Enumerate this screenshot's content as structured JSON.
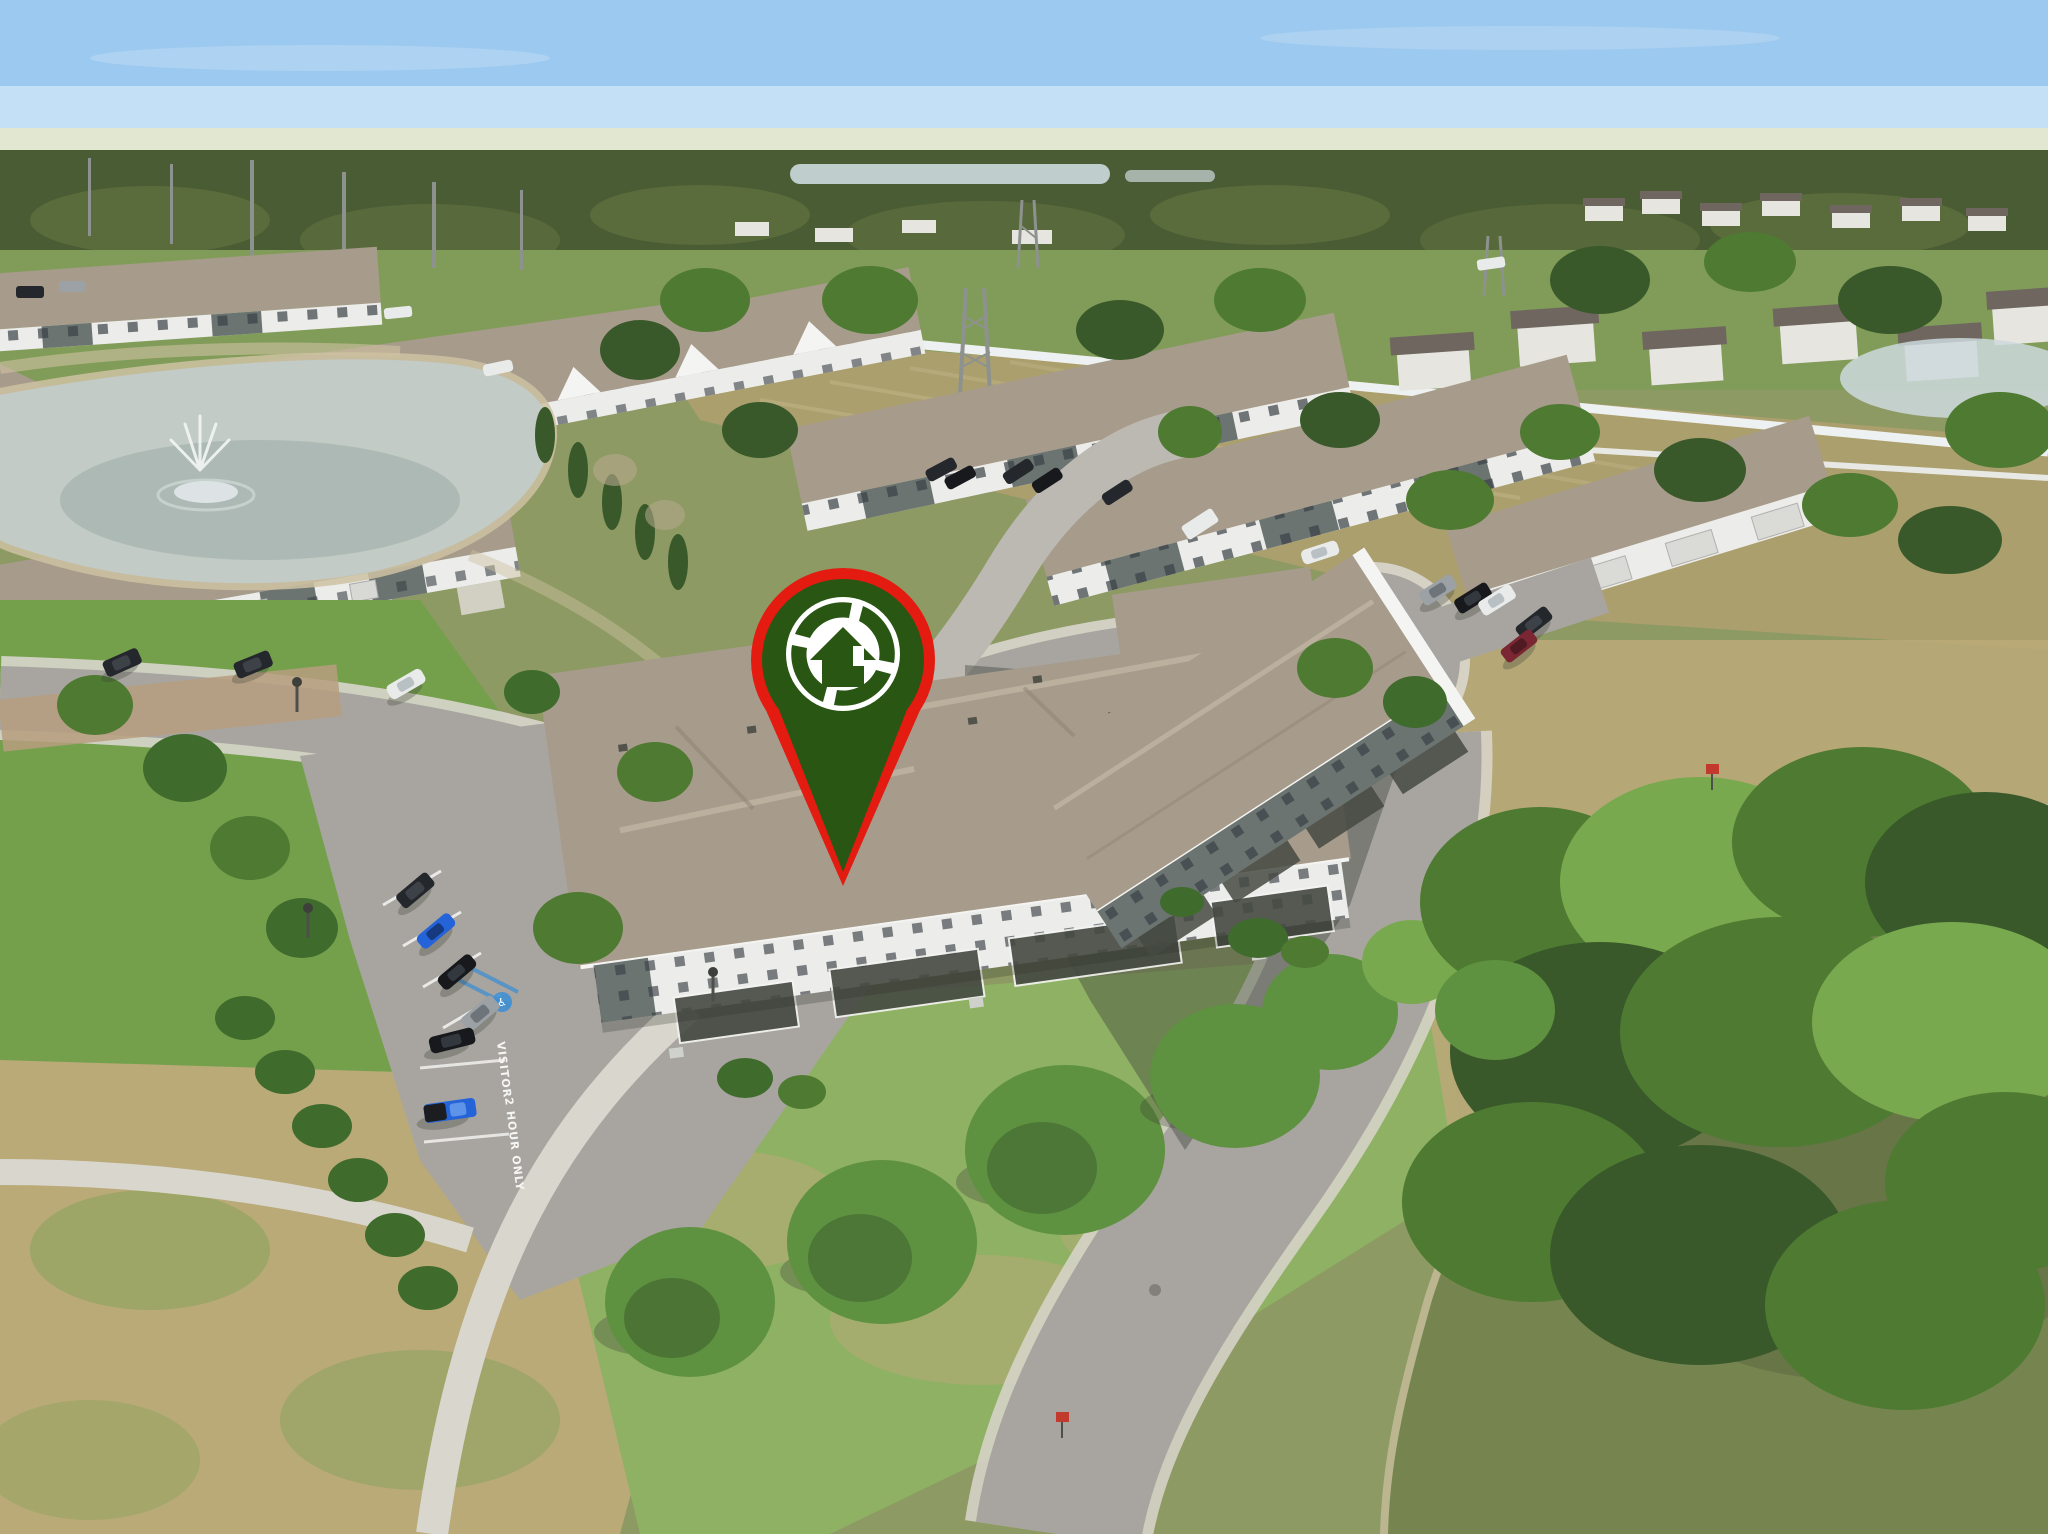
{
  "meta": {
    "title": "Aerial drone photo of townhome community with location pin",
    "type": "aerial-real-estate-photo"
  },
  "scene": {
    "description": "Aerial view of a Florida townhome community: rows of two-story townhomes with tan shingle roofs and white/gray walls, a retention pond with fountain at left, curving streets with a visitor parking lot, a cul-de-sac at right, a green lake at bottom right lined with pine trees, distant suburbs on the horizon, and a dark-green map pin with red border marking the subject townhome."
  },
  "pin": {
    "name": "property-location-pin",
    "logo": "aperture-house-logo",
    "fill": "#2a5614",
    "border": "#e31b10"
  },
  "markings": {
    "visitor": "VISITOR",
    "two_hour": "2 HOUR ONLY",
    "handicap_symbol": "♿"
  },
  "colors": {
    "sky_top": "#9cc9ef",
    "sky_bottom": "#d9edfa",
    "haze": "#e3e7cd",
    "far_trees": "#4a5c33",
    "far_trees_light": "#6a7c46",
    "distant_house_wall": "#e6e5e0",
    "distant_house_roof": "#6f675f",
    "distant_water": "#ccd9dd",
    "ground_base": "#8d9a63",
    "field_tan": "#ab9f6e",
    "mow_line": "#c3b687",
    "grass_green": "#74a04c",
    "grass_light": "#8fb164",
    "grass_dry": "#b9aa78",
    "road": "#a8a5a0",
    "road_light": "#bcb9b3",
    "sidewalk": "#d9d6cd",
    "paver": "#b79d7f",
    "shadow": "#3a3e36",
    "pond_light": "#c2cbc6",
    "pond_dark": "#95a39e",
    "fountain_white": "#f2f6f4",
    "lake_light": "#76854f",
    "lake_dark": "#57663f",
    "shore_sand": "#cec2a2",
    "fence_white": "#eef1f1",
    "tree_green": "#4e7a32",
    "tree_light": "#79a94e",
    "tree_dark": "#39592a",
    "pine_green": "#5e9140",
    "shrub": "#3f6b2d",
    "roof_tan": "#a79b8b",
    "roof_light": "#c3b8a6",
    "roof_dark": "#8d8172",
    "wall_white": "#ececea",
    "wall_gray": "#6b7470",
    "window": "#394046",
    "trim_white": "#f4f4f2",
    "porch_dark": "#454a42",
    "car_dark": "#24272b",
    "car_black": "#17191c",
    "car_blue": "#2563d8",
    "car_gray": "#9ba1a5",
    "car_white": "#e9ebea",
    "car_red": "#7b2733",
    "pole_gray": "#8e928f",
    "pin_green": "#2a5614",
    "pin_red": "#e31b10",
    "logo_white": "#ffffff",
    "marking_white": "#f5f5f3",
    "handicap_blue": "#3f8fd1"
  }
}
